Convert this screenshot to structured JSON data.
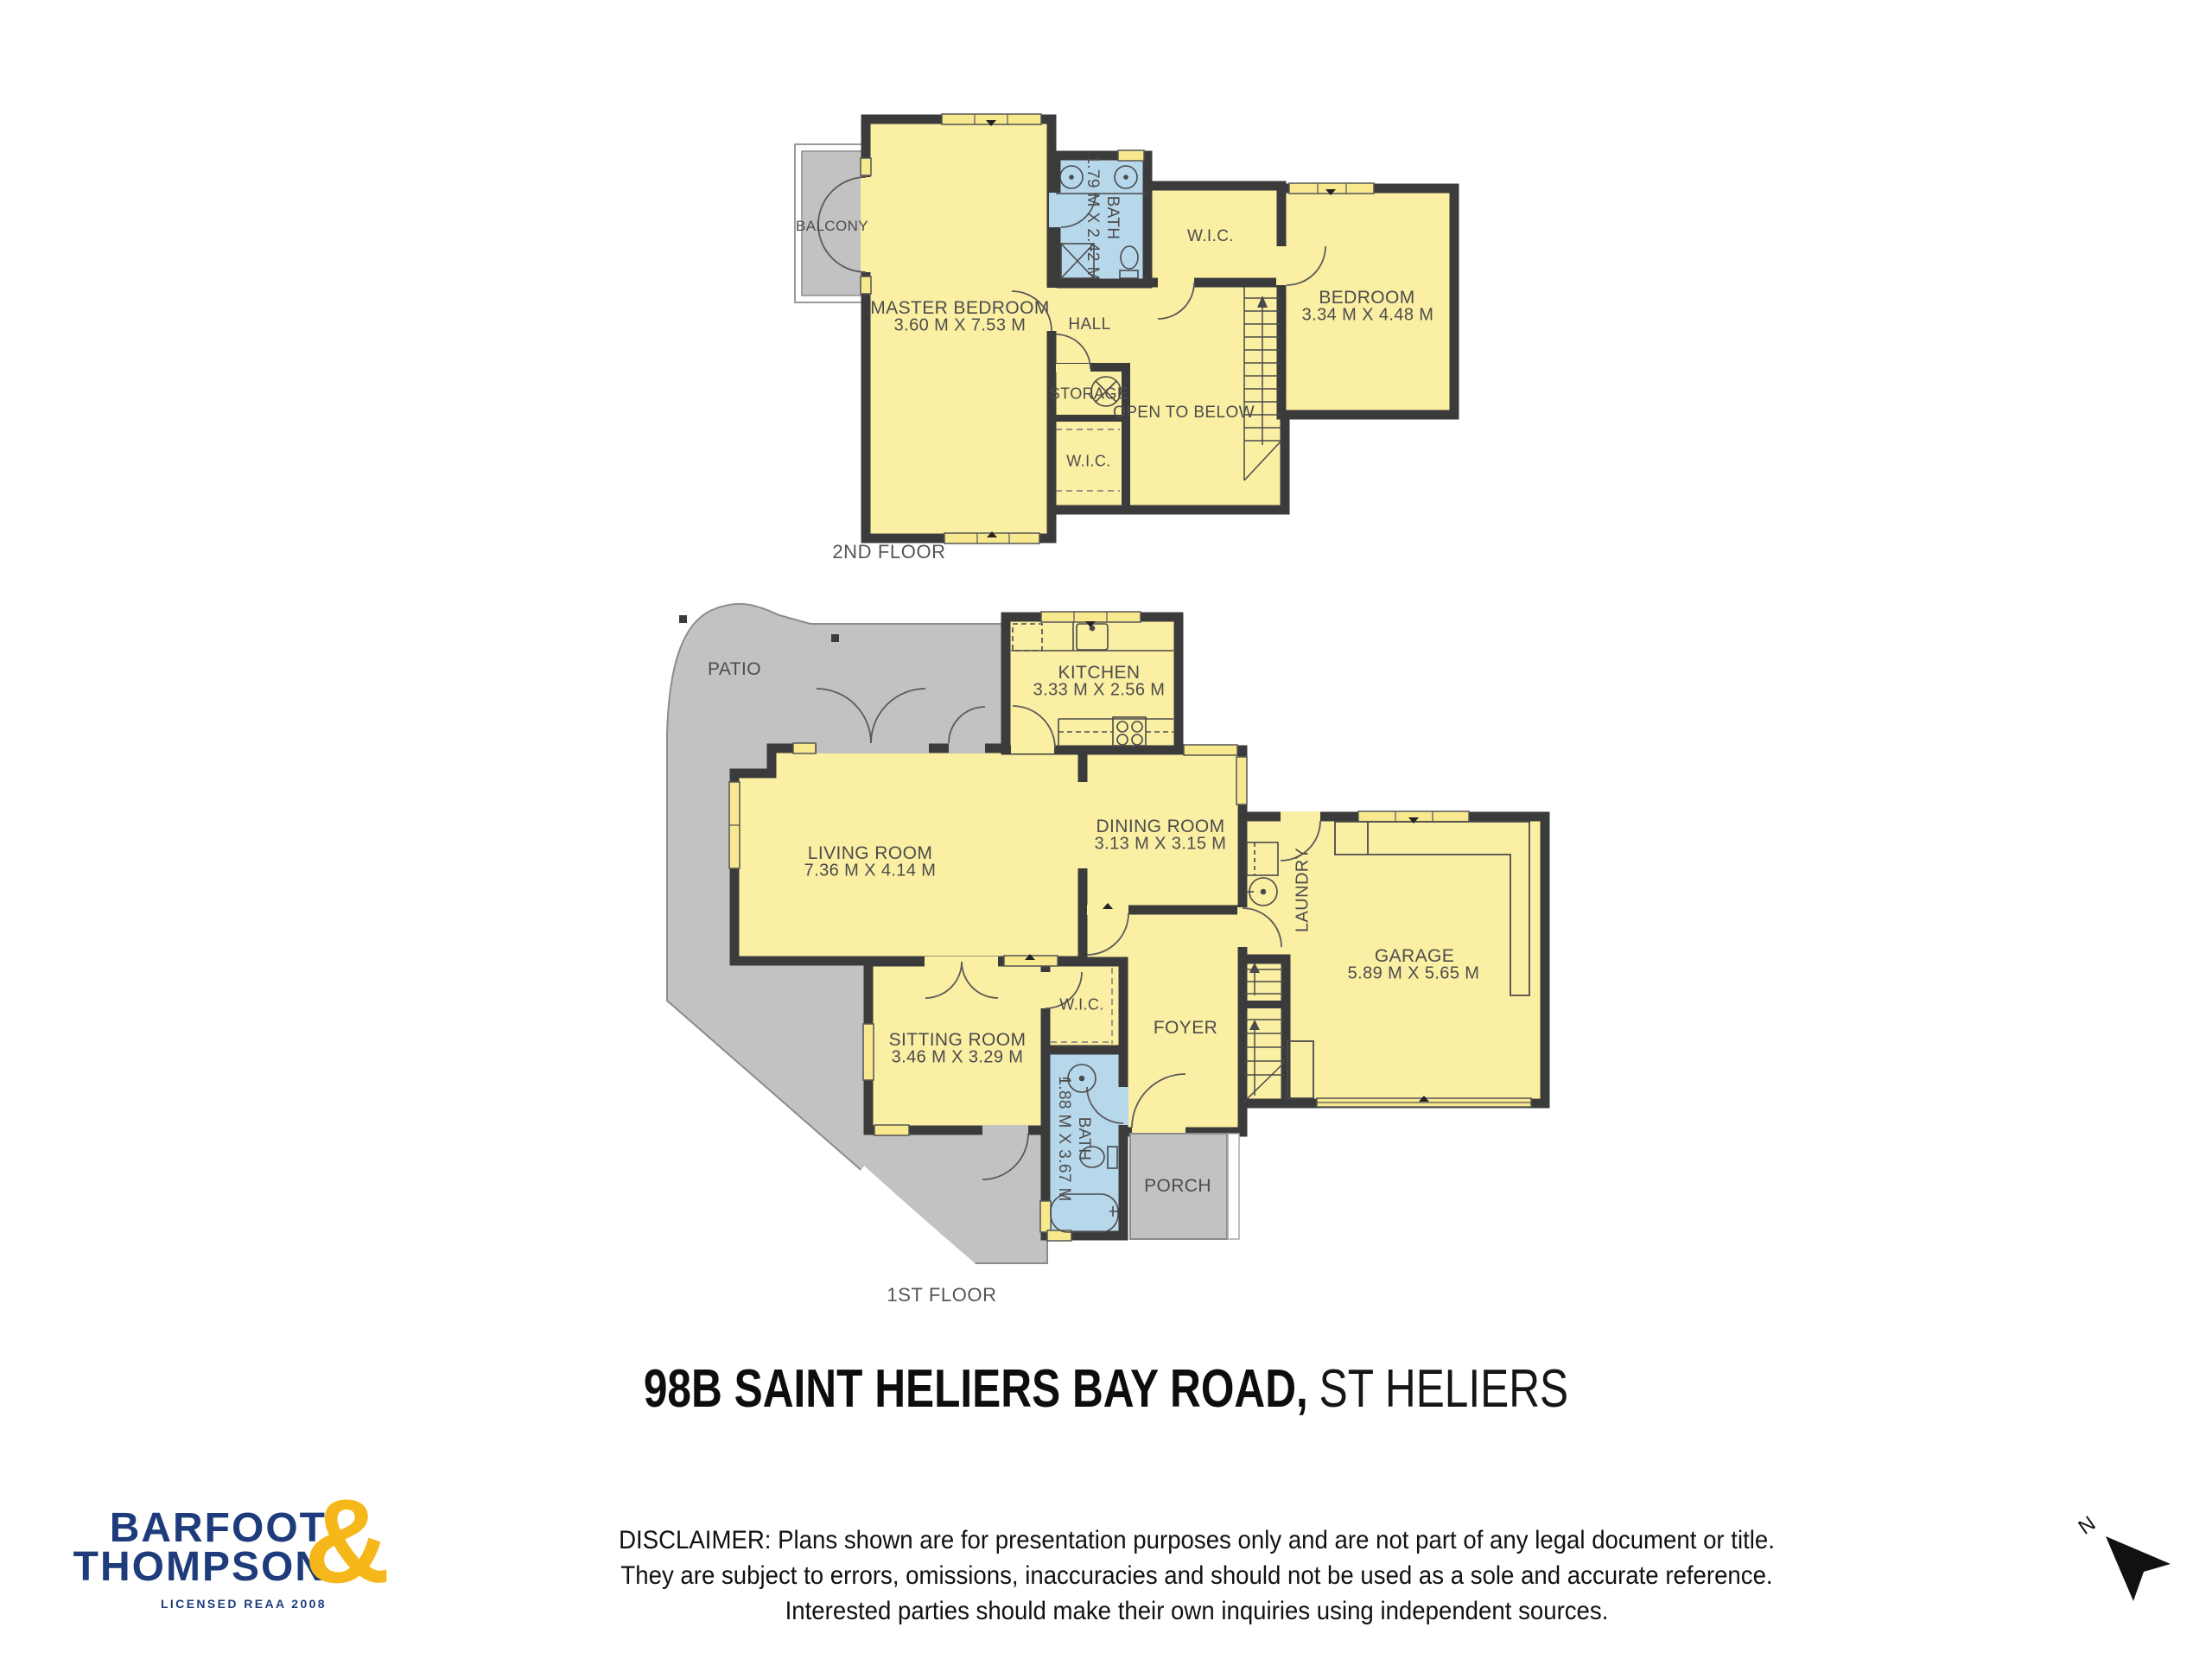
{
  "title": {
    "address_bold": "98B SAINT HELIERS BAY ROAD,",
    "suburb": "ST HELIERS"
  },
  "colors": {
    "room_yellow": "#fbefa4",
    "window_yellow": "#f8e98f",
    "wall_dark": "#3b3b3b",
    "bath_blue": "#b7d7eb",
    "outdoor_gray": "#c2c2c2",
    "brand_navy": "#1e3c7c",
    "brand_gold": "#f6b71b"
  },
  "floors": {
    "second": {
      "label": "2ND FLOOR",
      "balcony": "BALCONY",
      "master_name": "MASTER BEDROOM",
      "master_dims": "3.60 M X 7.53 M",
      "bath_name": "BATH",
      "bath_dims": "1.79 M X 2.42 M",
      "wic_top": "W.I.C.",
      "bedroom_name": "BEDROOM",
      "bedroom_dims": "3.34 M X 4.48 M",
      "hall": "HALL",
      "storage": "STORAGE",
      "open_below": "OPEN TO BELOW",
      "wic_lower": "W.I.C."
    },
    "first": {
      "label": "1ST FLOOR",
      "patio": "PATIO",
      "kitchen_name": "KITCHEN",
      "kitchen_dims": "3.33 M X 2.56 M",
      "living_name": "LIVING ROOM",
      "living_dims": "7.36 M X 4.14 M",
      "dining_name": "DINING ROOM",
      "dining_dims": "3.13 M X 3.15 M",
      "laundry": "LAUNDRY",
      "garage_name": "GARAGE",
      "garage_dims": "5.89 M X 5.65 M",
      "sitting_name": "SITTING ROOM",
      "sitting_dims": "3.46 M X 3.29 M",
      "wic": "W.I.C.",
      "foyer": "FOYER",
      "bath_name": "BATH",
      "bath_dims": "1.88 M X 3.67 M",
      "porch": "PORCH"
    }
  },
  "disclaimer": {
    "line1": "DISCLAIMER: Plans shown are for presentation purposes only and are not part of any legal document or title.",
    "line2": "They are subject to errors, omissions, inaccuracies and should not be used as a sole and accurate reference.",
    "line3": "Interested parties should make their own inquiries using independent sources."
  },
  "logo": {
    "barfoot": "BARFOOT",
    "thompson": "THOMPSON",
    "ampersand": "&",
    "tagline": "LICENSED REAA 2008"
  },
  "compass": {
    "north": "N"
  }
}
